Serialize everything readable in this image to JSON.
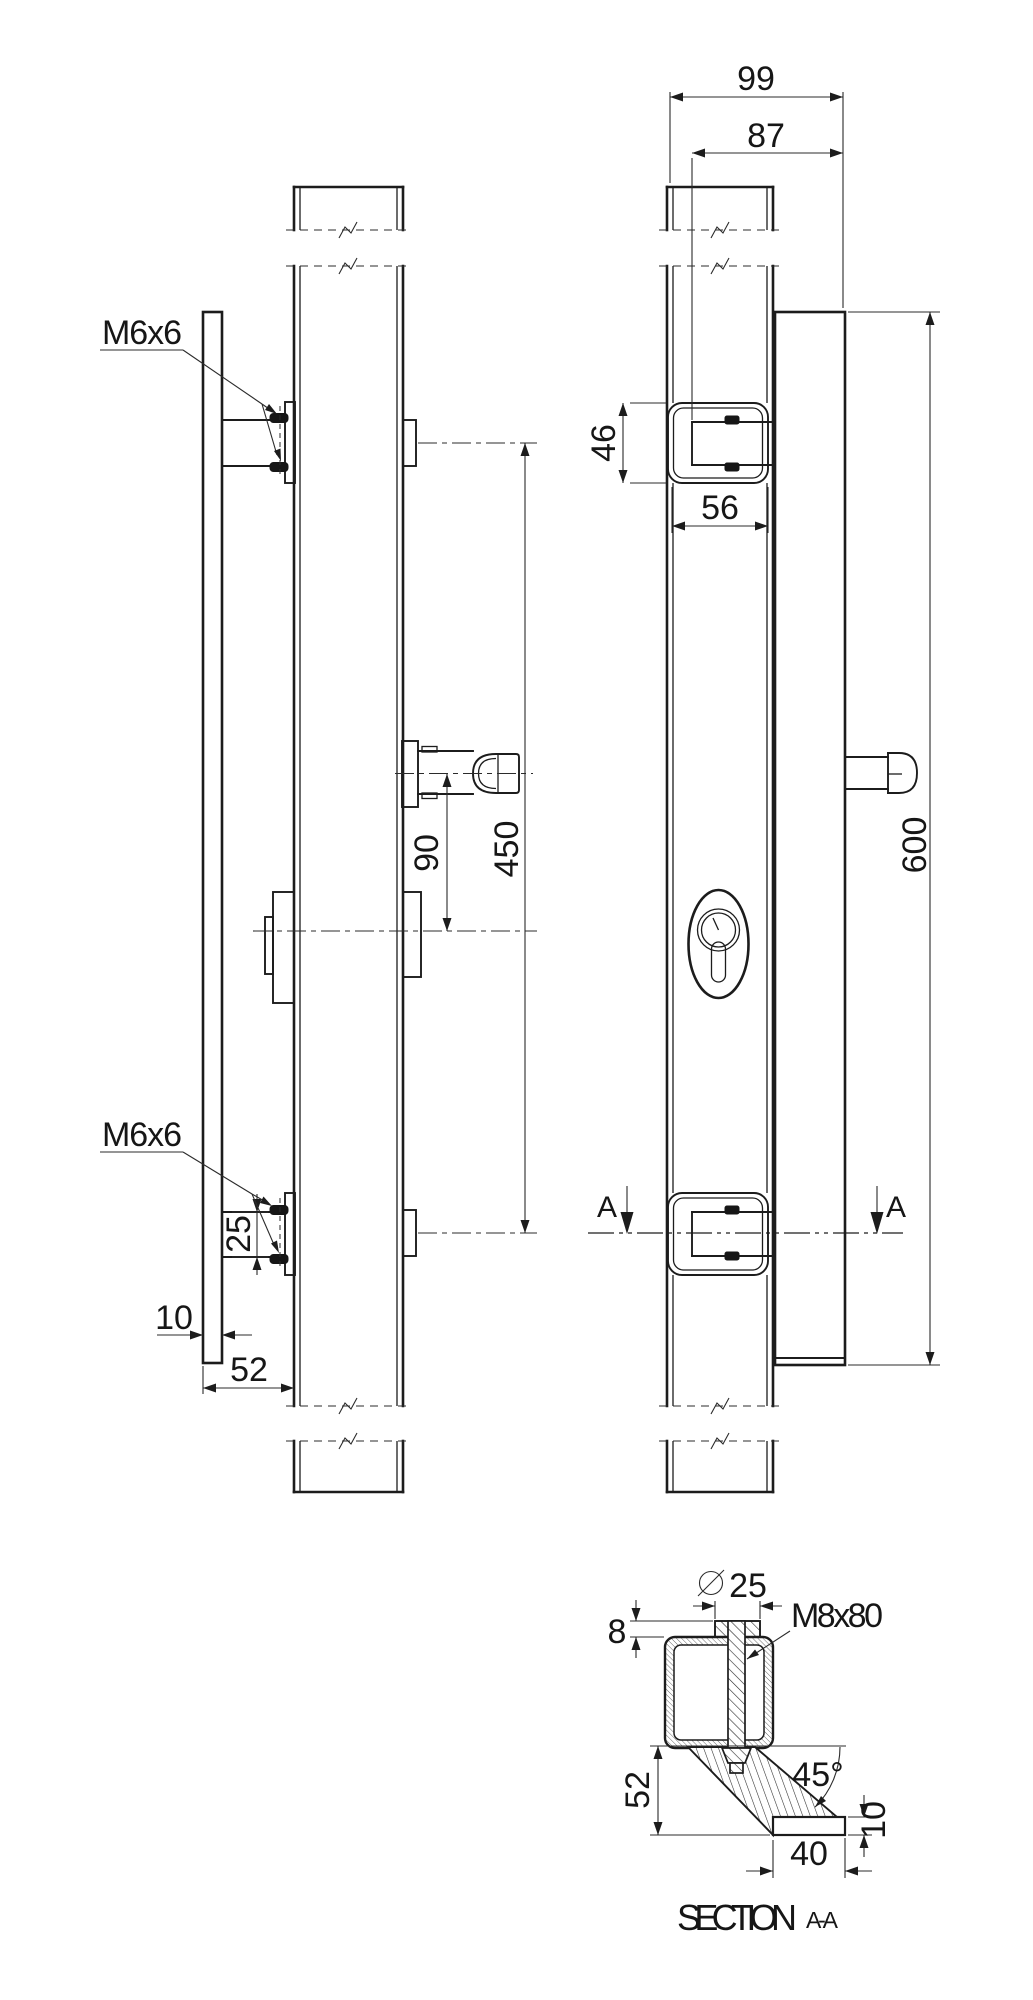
{
  "colors": {
    "background": "#ffffff",
    "line": "#1c1c1c",
    "text": "#161616"
  },
  "side_view": {
    "thread_label_top": "M6x6",
    "thread_label_bottom": "M6x6",
    "dim_knob_to_cylinder": "90",
    "dim_mount_centers": "450",
    "dim_screw_spacing": "25",
    "dim_plate_thickness": "10",
    "dim_handle_offset": "52"
  },
  "front_view": {
    "dim_overall_depth": "99",
    "dim_grip_depth": "87",
    "dim_bracket_height": "46",
    "dim_profile_width": "56",
    "dim_handle_length": "600",
    "section_marker_left": "A",
    "section_marker_right": "A"
  },
  "section_view": {
    "dim_tube_diameter": "25",
    "bolt_label": "M8x80",
    "dim_cap_height": "8",
    "dim_angle": "45°",
    "dim_bracket_height": "52",
    "dim_plate_thickness": "10",
    "dim_plate_width": "40",
    "title": "SECTION",
    "title_ref": "A-A"
  }
}
